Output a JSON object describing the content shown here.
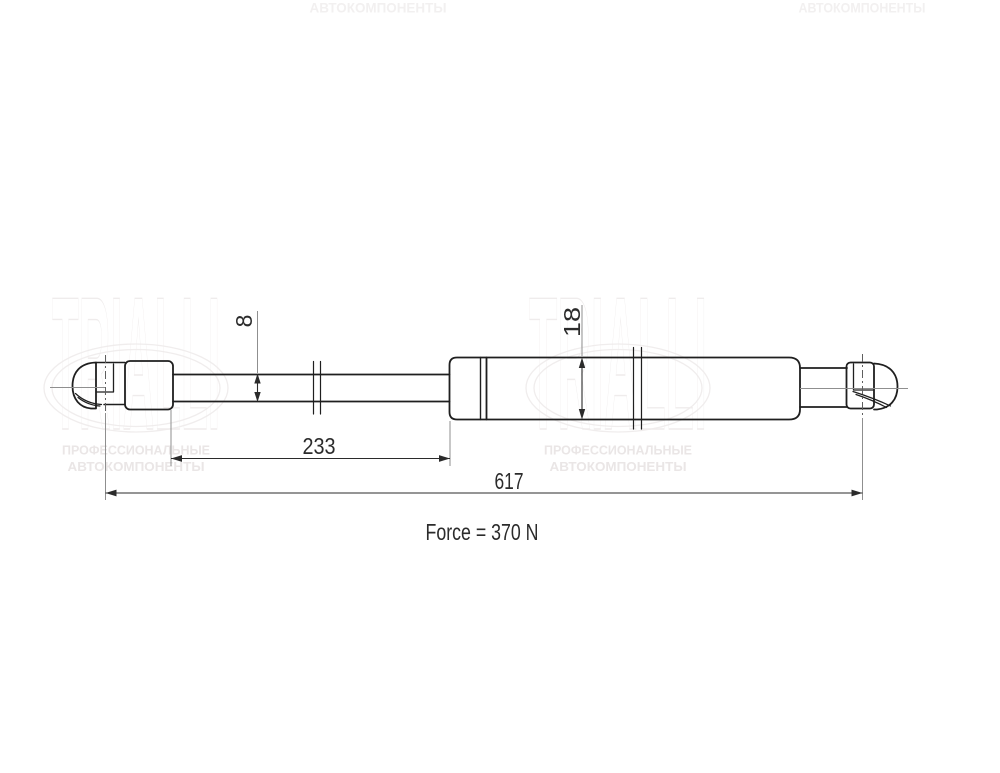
{
  "watermark": {
    "brand": "TRIALLI",
    "tagline_line1": "ПРОФЕССИОНАЛЬНЫЕ",
    "tagline_line2": "АВТОКОМПОНЕНТЫ",
    "logo_outline_color": "#efecec",
    "tagline_color": "#eae6e6",
    "top_text_color": "#f2f0f0"
  },
  "drawing": {
    "kind": "gas-spring-technical-drawing",
    "dimensions": {
      "rod_diameter": "8",
      "body_diameter": "18",
      "rod_length": "233",
      "total_length": "617"
    },
    "force_label": "Force = 370 N",
    "colors": {
      "outline": "#1f1f1f",
      "dimension": "#2b2b2b",
      "extension_line": "#8f8f8f"
    }
  }
}
